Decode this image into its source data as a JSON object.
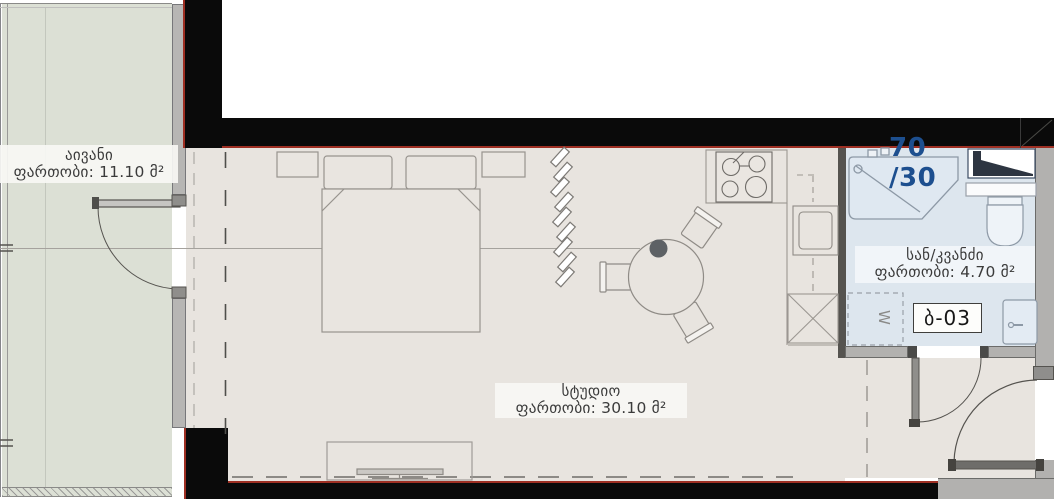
{
  "plan": {
    "type": "apartment-floor-plan",
    "unit_code": "ბ-03",
    "area_ratio": "70 /30",
    "rooms": {
      "balcony": {
        "name": "აივანი",
        "area": "ფართობი: 11.10 მ²"
      },
      "studio": {
        "name": "სტუდიო",
        "area": "ფართობი: 30.10 მ²"
      },
      "bathroom": {
        "name": "სან/კვანძი",
        "area": "ფართობი: 4.70 მ²"
      }
    },
    "symbols": {
      "washing_machine": "W"
    },
    "colors": {
      "balcony_floor": "#dce0d5",
      "studio_floor": "#e8e4df",
      "bathroom_floor": "#dde6ee",
      "wall_dark": "#0a0a0a",
      "wall_gray": "#b2b1af",
      "accent_red": "#9e2f23",
      "ratio_text": "#1d4f8f",
      "label_text": "#3b3b3b",
      "table_decor": "#5d6165"
    }
  }
}
